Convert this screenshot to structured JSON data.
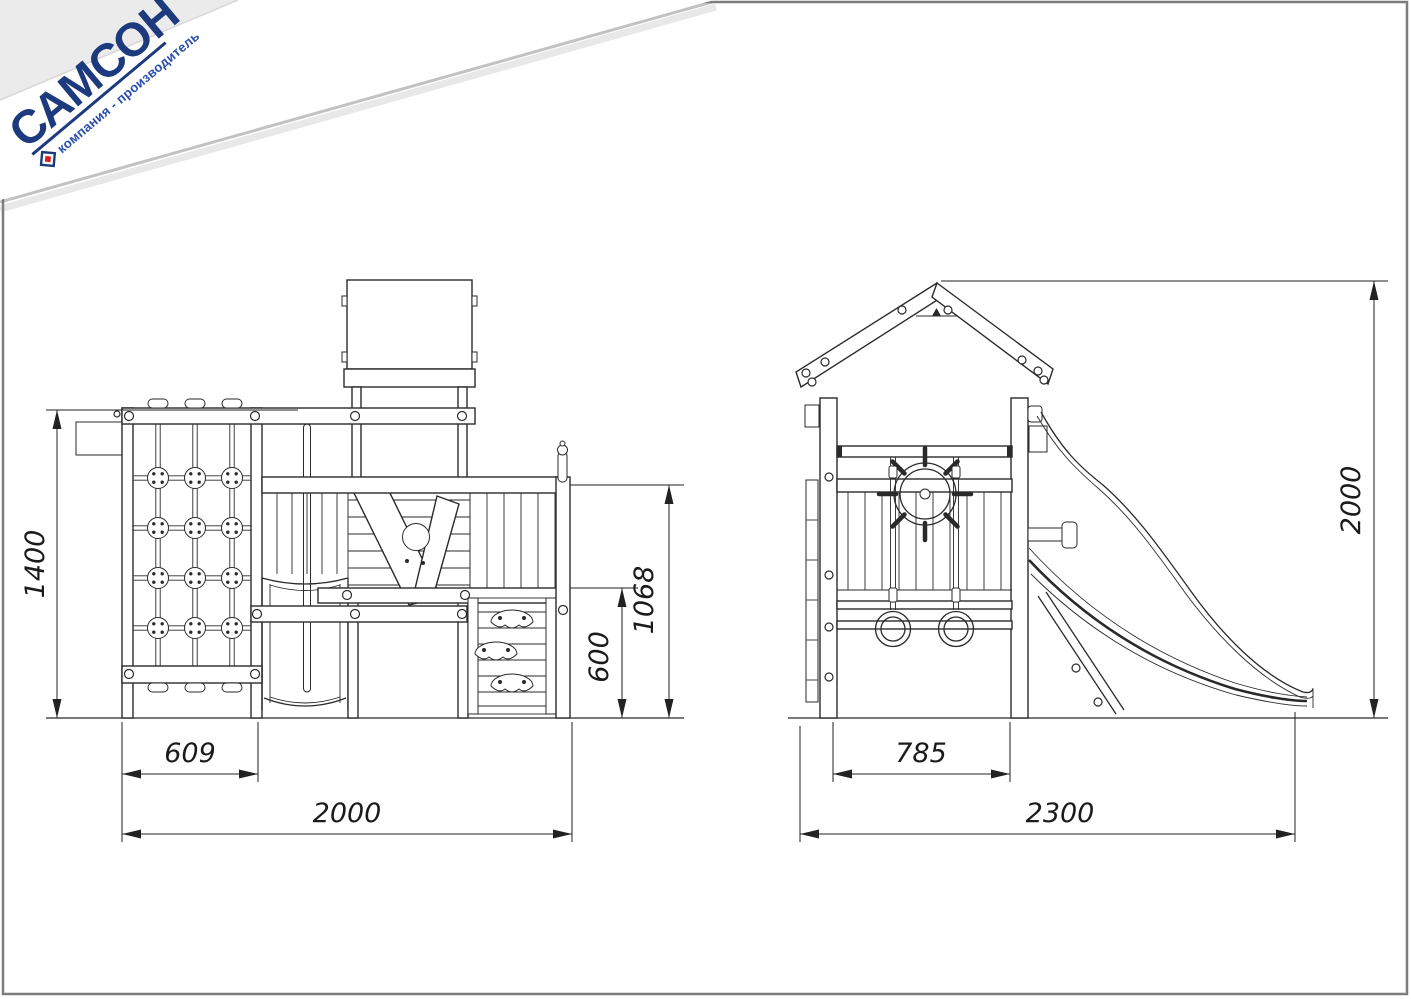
{
  "logo": {
    "brand": "САМСОН",
    "tagline": "компания - производитель"
  },
  "colors": {
    "brand_navy": "#1c3a7d",
    "brand_blue": "#2a4fae",
    "brand_red": "#e01b1b",
    "line": "#2a2a2a",
    "border_gray": "#7d7d7d",
    "corner_gray": "#ebebeb"
  },
  "dimensions": {
    "front": {
      "total_height": "1400",
      "net_width": "609",
      "total_width": "2000",
      "deck_height": "1068",
      "wall_height": "600"
    },
    "side": {
      "platform_width": "785",
      "total_width": "2300",
      "total_height": "2000"
    }
  }
}
